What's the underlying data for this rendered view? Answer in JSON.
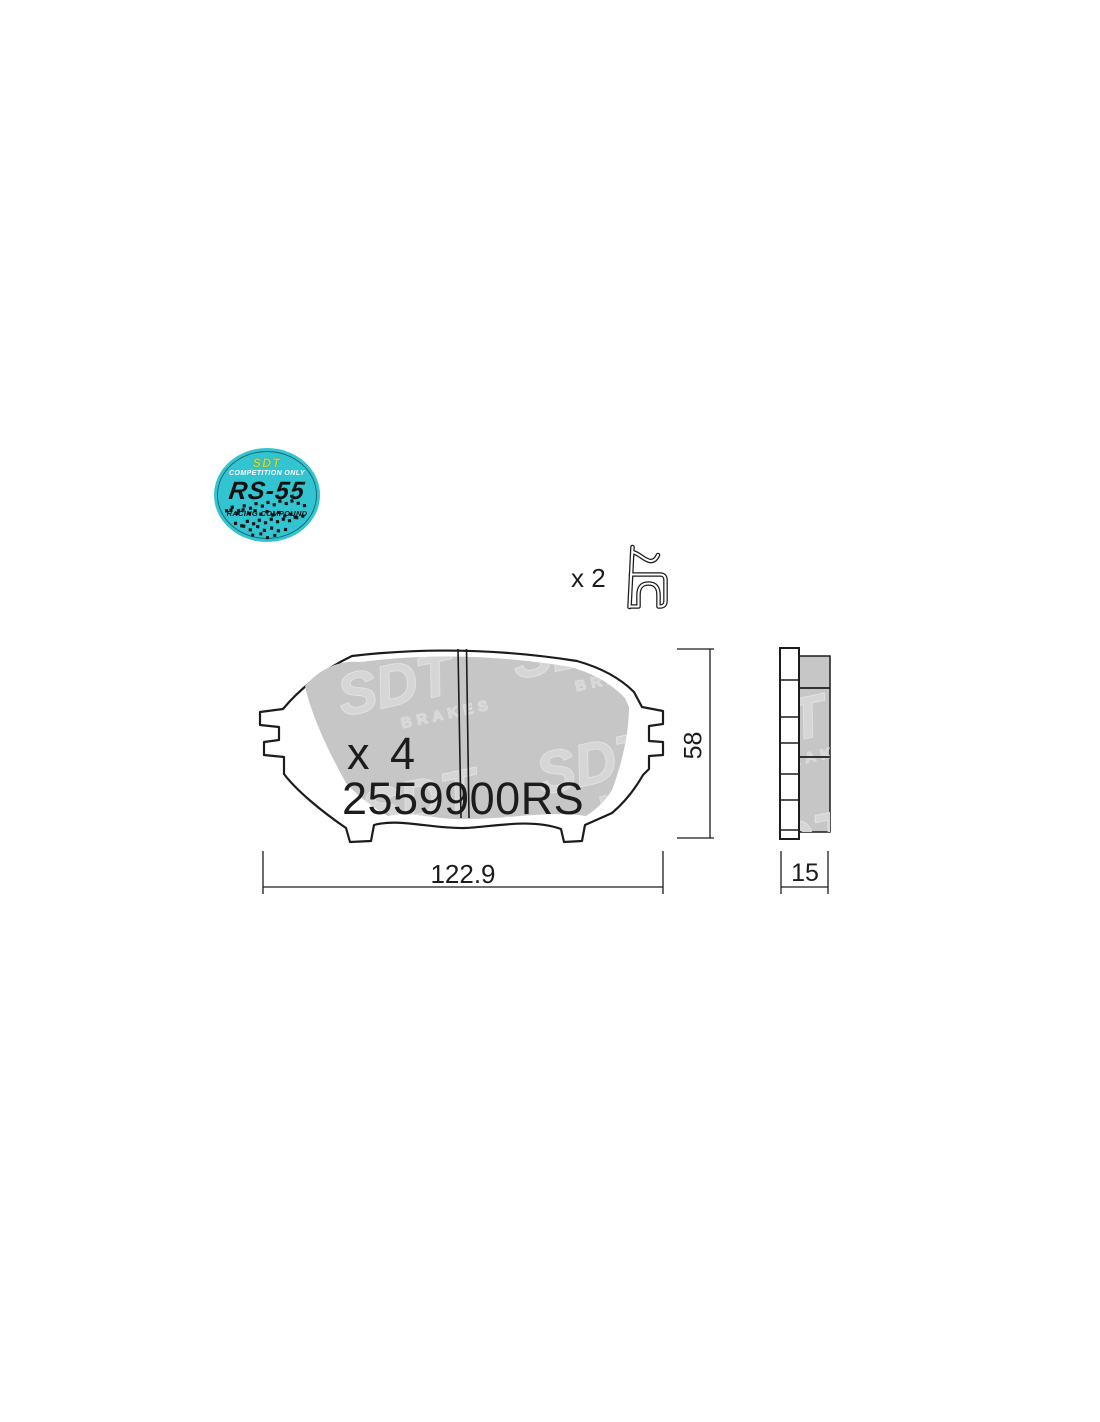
{
  "badge": {
    "brand": "SDT",
    "tagline_top": "COMPETITION ONLY",
    "compound_name": "RS-55",
    "tagline_bottom": "RACING COMPOUND",
    "background_color": "#33c4d1",
    "brand_text_color": "#ccd83c"
  },
  "spring_clip": {
    "quantity_label": "x 2"
  },
  "brake_pad": {
    "quantity_label": "x 4",
    "part_number": "2559900RS",
    "friction_color": "#c6c6c6",
    "watermark_brand": "SDT",
    "watermark_sub": "BRAKES",
    "watermark_color": "#d6d6d6"
  },
  "dimensions": {
    "width": "122.9",
    "height": "58",
    "thickness": "15"
  },
  "drawing": {
    "line_color": "#1c1c1c"
  }
}
